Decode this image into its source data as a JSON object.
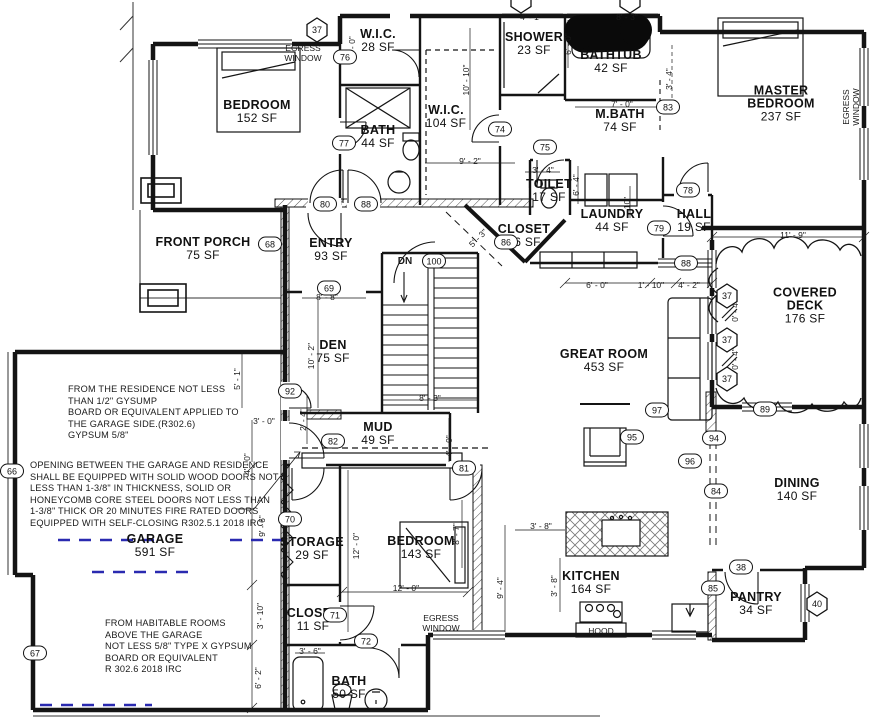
{
  "drawing": {
    "type": "residential floor plan",
    "colors": {
      "line": "#141414",
      "garage_dash": "#2a2ab0",
      "paper": "#ffffff",
      "redaction": "#0a0a0a"
    }
  },
  "rooms": [
    {
      "id": "bedroom-1",
      "name": "BEDROOM",
      "sf": "152 SF",
      "x": 257,
      "y": 112
    },
    {
      "id": "wic-28",
      "name": "W.I.C.",
      "sf": "28 SF",
      "x": 378,
      "y": 41
    },
    {
      "id": "bath-44",
      "name": "BATH",
      "sf": "44 SF",
      "x": 378,
      "y": 137
    },
    {
      "id": "wic-104",
      "name": "W.I.C.",
      "sf": "104 SF",
      "x": 446,
      "y": 117
    },
    {
      "id": "shower",
      "name": "SHOWER",
      "sf": "23 SF",
      "x": 534,
      "y": 44
    },
    {
      "id": "bathtub",
      "name": "BATHTUB",
      "sf": "42 SF",
      "x": 611,
      "y": 62
    },
    {
      "id": "master-bath",
      "name": "M.BATH",
      "sf": "74 SF",
      "x": 620,
      "y": 121
    },
    {
      "id": "master-bedroom",
      "name": "MASTER\nBEDROOM",
      "sf": "237 SF",
      "x": 781,
      "y": 104
    },
    {
      "id": "toilet",
      "name": "TOILET",
      "sf": "17 SF",
      "x": 549,
      "y": 191
    },
    {
      "id": "laundry",
      "name": "LAUNDRY",
      "sf": "44 SF",
      "x": 612,
      "y": 221
    },
    {
      "id": "hall",
      "name": "HALL",
      "sf": "19 SF",
      "x": 694,
      "y": 221
    },
    {
      "id": "closet-16",
      "name": "CLOSET",
      "sf": "16 SF",
      "x": 524,
      "y": 236
    },
    {
      "id": "front-porch",
      "name": "FRONT PORCH",
      "sf": "75 SF",
      "x": 203,
      "y": 249
    },
    {
      "id": "entry",
      "name": "ENTRY",
      "sf": "93 SF",
      "x": 331,
      "y": 250
    },
    {
      "id": "covered-deck",
      "name": "COVERED DECK",
      "sf": "176 SF",
      "x": 805,
      "y": 306
    },
    {
      "id": "den",
      "name": "DEN",
      "sf": "75 SF",
      "x": 333,
      "y": 352
    },
    {
      "id": "great-room",
      "name": "GREAT ROOM",
      "sf": "453 SF",
      "x": 604,
      "y": 361
    },
    {
      "id": "mud",
      "name": "MUD",
      "sf": "49 SF",
      "x": 378,
      "y": 434
    },
    {
      "id": "garage",
      "name": "GARAGE",
      "sf": "591 SF",
      "x": 155,
      "y": 546
    },
    {
      "id": "storage",
      "name": "STORAGE",
      "sf": "29 SF",
      "x": 312,
      "y": 549
    },
    {
      "id": "bedroom-2",
      "name": "BEDROOM",
      "sf": "143 SF",
      "x": 421,
      "y": 548
    },
    {
      "id": "dining",
      "name": "DINING",
      "sf": "140 SF",
      "x": 797,
      "y": 490
    },
    {
      "id": "kitchen",
      "name": "KITCHEN",
      "sf": "164 SF",
      "x": 591,
      "y": 583
    },
    {
      "id": "pantry",
      "name": "PANTRY",
      "sf": "34 SF",
      "x": 756,
      "y": 604
    },
    {
      "id": "closet-11",
      "name": "CLOSET",
      "sf": "11 SF",
      "x": 313,
      "y": 620
    },
    {
      "id": "bath-50",
      "name": "BATH",
      "sf": "50 SF",
      "x": 349,
      "y": 688
    }
  ],
  "tags": [
    {
      "label": "37",
      "shape": "hex",
      "x": 317,
      "y": 30
    },
    {
      "label": "",
      "shape": "hex",
      "x": 521,
      "y": 1
    },
    {
      "label": "",
      "shape": "hex",
      "x": 630,
      "y": 1
    },
    {
      "label": "37",
      "shape": "hex",
      "x": 727,
      "y": 296
    },
    {
      "label": "37",
      "shape": "hex",
      "x": 727,
      "y": 340
    },
    {
      "label": "37",
      "shape": "hex",
      "x": 727,
      "y": 379
    },
    {
      "label": "40",
      "shape": "hex",
      "x": 817,
      "y": 604
    },
    {
      "label": "76",
      "shape": "oval",
      "x": 345,
      "y": 57
    },
    {
      "label": "77",
      "shape": "oval",
      "x": 344,
      "y": 143
    },
    {
      "label": "80",
      "shape": "oval",
      "x": 325,
      "y": 204
    },
    {
      "label": "88",
      "shape": "oval",
      "x": 366,
      "y": 204
    },
    {
      "label": "68",
      "shape": "oval",
      "x": 270,
      "y": 244
    },
    {
      "label": "74",
      "shape": "oval",
      "x": 500,
      "y": 129
    },
    {
      "label": "75",
      "shape": "oval",
      "x": 545,
      "y": 147
    },
    {
      "label": "83",
      "shape": "oval",
      "x": 668,
      "y": 107
    },
    {
      "label": "78",
      "shape": "oval",
      "x": 688,
      "y": 190
    },
    {
      "label": "79",
      "shape": "oval",
      "x": 659,
      "y": 228
    },
    {
      "label": "88",
      "shape": "oval",
      "x": 686,
      "y": 263
    },
    {
      "label": "100",
      "shape": "oval",
      "x": 434,
      "y": 261
    },
    {
      "label": "69",
      "shape": "oval",
      "x": 329,
      "y": 288
    },
    {
      "label": "86",
      "shape": "oval",
      "x": 506,
      "y": 242
    },
    {
      "label": "92",
      "shape": "oval",
      "x": 290,
      "y": 391
    },
    {
      "label": "82",
      "shape": "oval",
      "x": 333,
      "y": 441
    },
    {
      "label": "81",
      "shape": "oval",
      "x": 464,
      "y": 468
    },
    {
      "label": "97",
      "shape": "oval",
      "x": 657,
      "y": 410
    },
    {
      "label": "95",
      "shape": "oval",
      "x": 632,
      "y": 437
    },
    {
      "label": "94",
      "shape": "oval",
      "x": 714,
      "y": 438
    },
    {
      "label": "96",
      "shape": "oval",
      "x": 690,
      "y": 461
    },
    {
      "label": "84",
      "shape": "oval",
      "x": 716,
      "y": 491
    },
    {
      "label": "89",
      "shape": "oval",
      "x": 765,
      "y": 409
    },
    {
      "label": "70",
      "shape": "oval",
      "x": 290,
      "y": 519
    },
    {
      "label": "66",
      "shape": "oval",
      "x": 12,
      "y": 471
    },
    {
      "label": "67",
      "shape": "oval",
      "x": 35,
      "y": 653
    },
    {
      "label": "71",
      "shape": "oval",
      "x": 335,
      "y": 615
    },
    {
      "label": "72",
      "shape": "oval",
      "x": 366,
      "y": 641
    },
    {
      "label": "85",
      "shape": "oval",
      "x": 713,
      "y": 588
    },
    {
      "label": "38",
      "shape": "oval",
      "x": 741,
      "y": 567
    }
  ],
  "dimensions": [
    {
      "text": "4' - 1\"",
      "x": 531,
      "y": 17,
      "rot": 0
    },
    {
      "text": "8' - 3\"",
      "x": 627,
      "y": 17,
      "rot": 0
    },
    {
      "text": "10' - 10\"",
      "x": 466,
      "y": 80,
      "rot": -90
    },
    {
      "text": "6' - 0\"",
      "x": 352,
      "y": 47,
      "rot": -90
    },
    {
      "text": "6' - 0\"",
      "x": 568,
      "y": 44,
      "rot": -90
    },
    {
      "text": "7' - 0\"",
      "x": 622,
      "y": 104,
      "rot": 0
    },
    {
      "text": "3' - 4\"",
      "x": 669,
      "y": 79,
      "rot": -90
    },
    {
      "text": "9' - 2\"",
      "x": 470,
      "y": 161,
      "rot": 0
    },
    {
      "text": "3' - 4\"",
      "x": 543,
      "y": 170,
      "rot": 0
    },
    {
      "text": "6' - 4\"",
      "x": 576,
      "y": 185,
      "rot": -90
    },
    {
      "text": "10\"",
      "x": 627,
      "y": 203,
      "rot": -90
    },
    {
      "text": "5' - 3\"",
      "x": 478,
      "y": 238,
      "rot": -45
    },
    {
      "text": "8' - 8\"",
      "x": 327,
      "y": 297,
      "rot": 0
    },
    {
      "text": "10' - 2\"",
      "x": 311,
      "y": 356,
      "rot": -90
    },
    {
      "text": "11' - 9\"",
      "x": 793,
      "y": 235,
      "rot": 0
    },
    {
      "text": "6' - 0\"",
      "x": 597,
      "y": 285,
      "rot": 0
    },
    {
      "text": "1' - 10\"",
      "x": 651,
      "y": 285,
      "rot": 0
    },
    {
      "text": "4' - 2\"",
      "x": 689,
      "y": 285,
      "rot": 0
    },
    {
      "text": "0' - 4\"",
      "x": 735,
      "y": 311,
      "rot": -90
    },
    {
      "text": "0' - 4\"",
      "x": 735,
      "y": 359,
      "rot": -90
    },
    {
      "text": "8' - 3\"",
      "x": 430,
      "y": 398,
      "rot": 0
    },
    {
      "text": "5' - 1\"",
      "x": 237,
      "y": 379,
      "rot": -90
    },
    {
      "text": "3' - 0\"",
      "x": 264,
      "y": 421,
      "rot": 0
    },
    {
      "text": "2' - 4\"",
      "x": 303,
      "y": 420,
      "rot": -90
    },
    {
      "text": "4' - 0\"",
      "x": 247,
      "y": 464,
      "rot": -90
    },
    {
      "text": "4' - 0\"",
      "x": 449,
      "y": 446,
      "rot": -90
    },
    {
      "text": "9' - 6\"",
      "x": 262,
      "y": 526,
      "rot": -90
    },
    {
      "text": "3' - 10\"",
      "x": 260,
      "y": 616,
      "rot": -90
    },
    {
      "text": "6' - 2\"",
      "x": 258,
      "y": 678,
      "rot": -90
    },
    {
      "text": "12' - 0\"",
      "x": 356,
      "y": 546,
      "rot": -90
    },
    {
      "text": "12' - 0\"",
      "x": 406,
      "y": 588,
      "rot": 0
    },
    {
      "text": "8' - 7\"",
      "x": 456,
      "y": 534,
      "rot": -90
    },
    {
      "text": "9' - 4\"",
      "x": 500,
      "y": 588,
      "rot": -90
    },
    {
      "text": "3' - 8\"",
      "x": 541,
      "y": 526,
      "rot": 0
    },
    {
      "text": "3' - 8\"",
      "x": 554,
      "y": 586,
      "rot": -90
    },
    {
      "text": "3' - 6\"",
      "x": 310,
      "y": 651,
      "rot": 0
    }
  ],
  "labels": [
    {
      "id": "egress-window-bedroom1",
      "text": "EGRESS\nWINDOW",
      "x": 303,
      "y": 53,
      "rot": 0,
      "big": false
    },
    {
      "id": "egress-window-master",
      "text": "EGRESS\nWINDOW",
      "x": 851,
      "y": 107,
      "rot": -90,
      "big": false
    },
    {
      "id": "egress-window-bedroom2",
      "text": "EGRESS\nWINDOW",
      "x": 441,
      "y": 623,
      "rot": 0,
      "big": false
    },
    {
      "id": "stair-direction",
      "text": "DN",
      "x": 405,
      "y": 262,
      "rot": 0,
      "big": true
    },
    {
      "id": "hood",
      "text": "HOOD",
      "x": 601,
      "y": 631,
      "rot": 0,
      "big": false
    }
  ],
  "notes": [
    {
      "id": "note-residence-gypsum",
      "x": 68,
      "y": 384,
      "text": "FROM THE RESIDENCE  NOT LESS\nTHAN 1/2\" GYSUMP\nBOARD OR EQUIVALENT APPLIED TO\nTHE GARAGE SIDE.(R302.6)\nGYPSUM 5/8\""
    },
    {
      "id": "note-garage-doors",
      "x": 30,
      "y": 460,
      "text": "OPENING BETWEEN THE GARAGE AND RESIDENCE\nSHALL BE EQUIPPED WITH SOLID WOOD DOORS NOT\nLESS THAN 1-3/8\" IN THICKNESS, SOLID OR\nHONEYCOMB CORE STEEL DOORS NOT LESS THAN\n1-3/8\" THICK OR 20 MINUTES FIRE RATED DOORS\nEQUIPPED WITH SELF-CLOSING R302.5.1 2018 IRC"
    },
    {
      "id": "note-habitable-rooms",
      "x": 105,
      "y": 618,
      "text": "FROM HABITABLE ROOMS\nABOVE THE GARAGE\nNOT LESS 5/8\" TYPE X GYPSUM\nBOARD OR EQUIVALENT\nR 302.6 2018 IRC"
    }
  ]
}
